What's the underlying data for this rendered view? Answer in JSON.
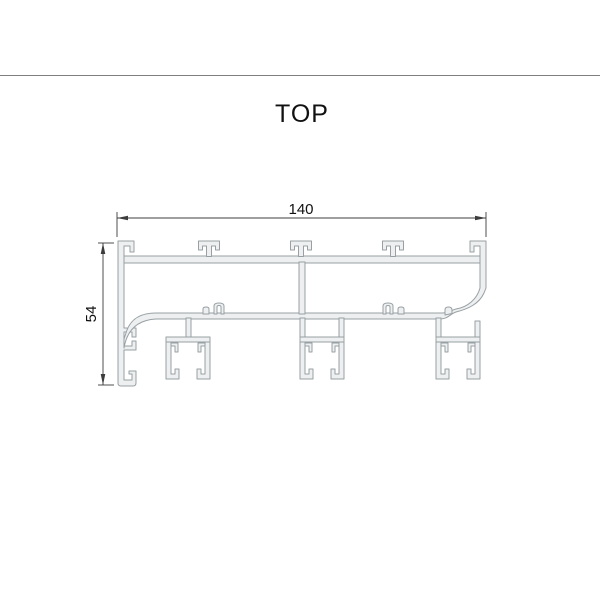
{
  "drawing": {
    "title": "TOP",
    "dimension_width": "140",
    "dimension_height": "54",
    "colors": {
      "profile_fill": "#edeff0",
      "profile_outline": "#98a0a3",
      "dimension_lines": "#3c3c3c",
      "header_rule": "#7f7f7f",
      "text": "#111111"
    }
  }
}
